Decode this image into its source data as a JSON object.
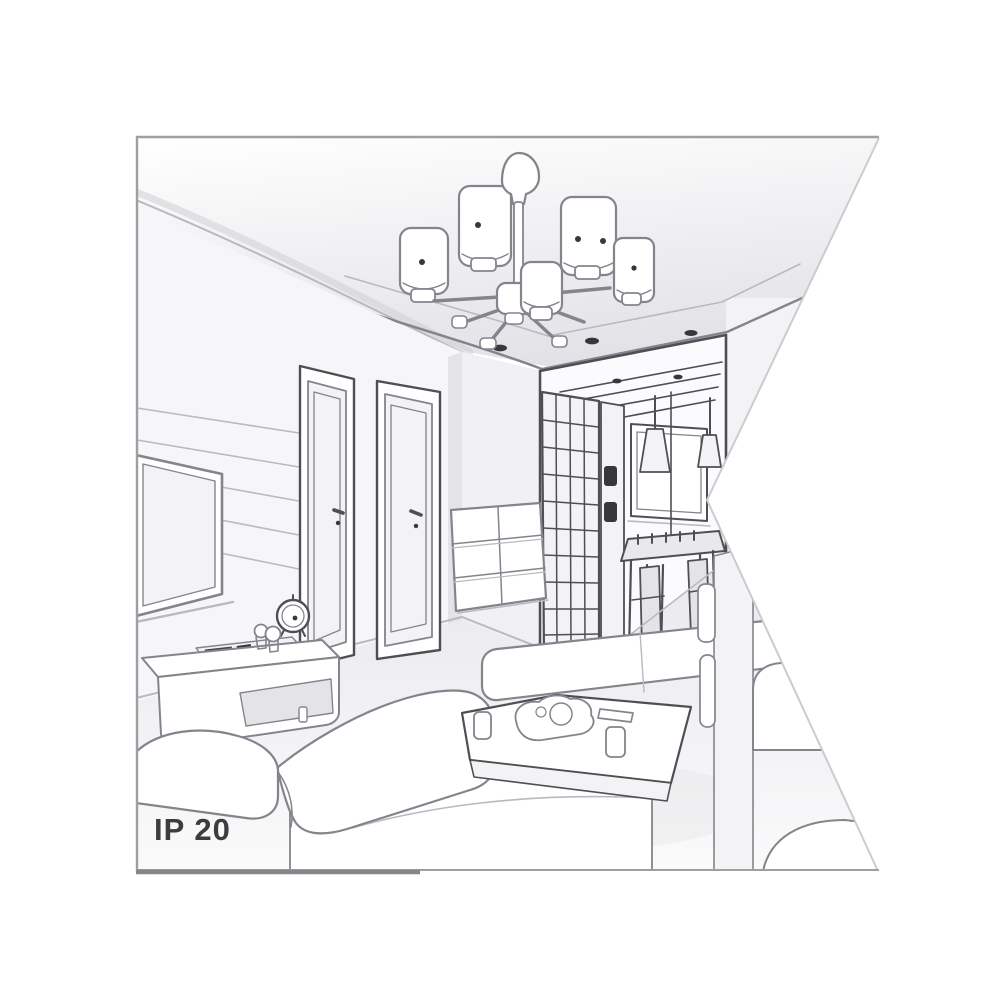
{
  "figure": {
    "type": "interior-line-illustration",
    "description": "Grayscale perspective sketch of a living room interior: six-light chandelier on a ceiling soffit with recessed spotlights, TV wall with slat paneling, two interior doors, hallway with glass wardrobe, dining nook with cone pendants, sofas, ottoman bench and coffee table. Right edge of the drawing is cut by a triangular white notch.",
    "style": "black-and-white product environment drawing"
  },
  "badge": {
    "text": "IP 20"
  },
  "colors": {
    "background": "#ffffff",
    "line": "#84848c",
    "line_dark": "#4e4e55",
    "line_soft": "#b9b9bf",
    "white": "#ffffff",
    "fill_light": "#f3f3f6",
    "fill_mid": "#e4e4e8",
    "ink": "#37373c",
    "text": "#3d3d3f",
    "frame": "#9e9ea3",
    "frame_dark": "#86868a",
    "notch_edge": "#cbcbd0",
    "ceil_hi": "#ffffff",
    "ceil_lo": "#dfdfe4",
    "floor_hi": "#e9e9ed",
    "floor_lo": "#fafafb",
    "wall": "#f6f6f9"
  },
  "objects": [
    "chandelier",
    "chandelier-shades",
    "ceiling-soffit",
    "recessed-spotlights",
    "left-wall-paneling",
    "television",
    "door-left",
    "door-right",
    "hallway",
    "glass-wardrobe",
    "wardrobe-door-panel",
    "window",
    "pendant-cone-lamps",
    "dining-table",
    "dining-chairs",
    "chest-of-drawers",
    "media-sideboard",
    "table-clock",
    "figurines",
    "sofa",
    "ottoman-bench",
    "coffee-table",
    "serving-tray",
    "cups",
    "remote-control",
    "right-sofa",
    "floor",
    "ip-rating-label"
  ]
}
